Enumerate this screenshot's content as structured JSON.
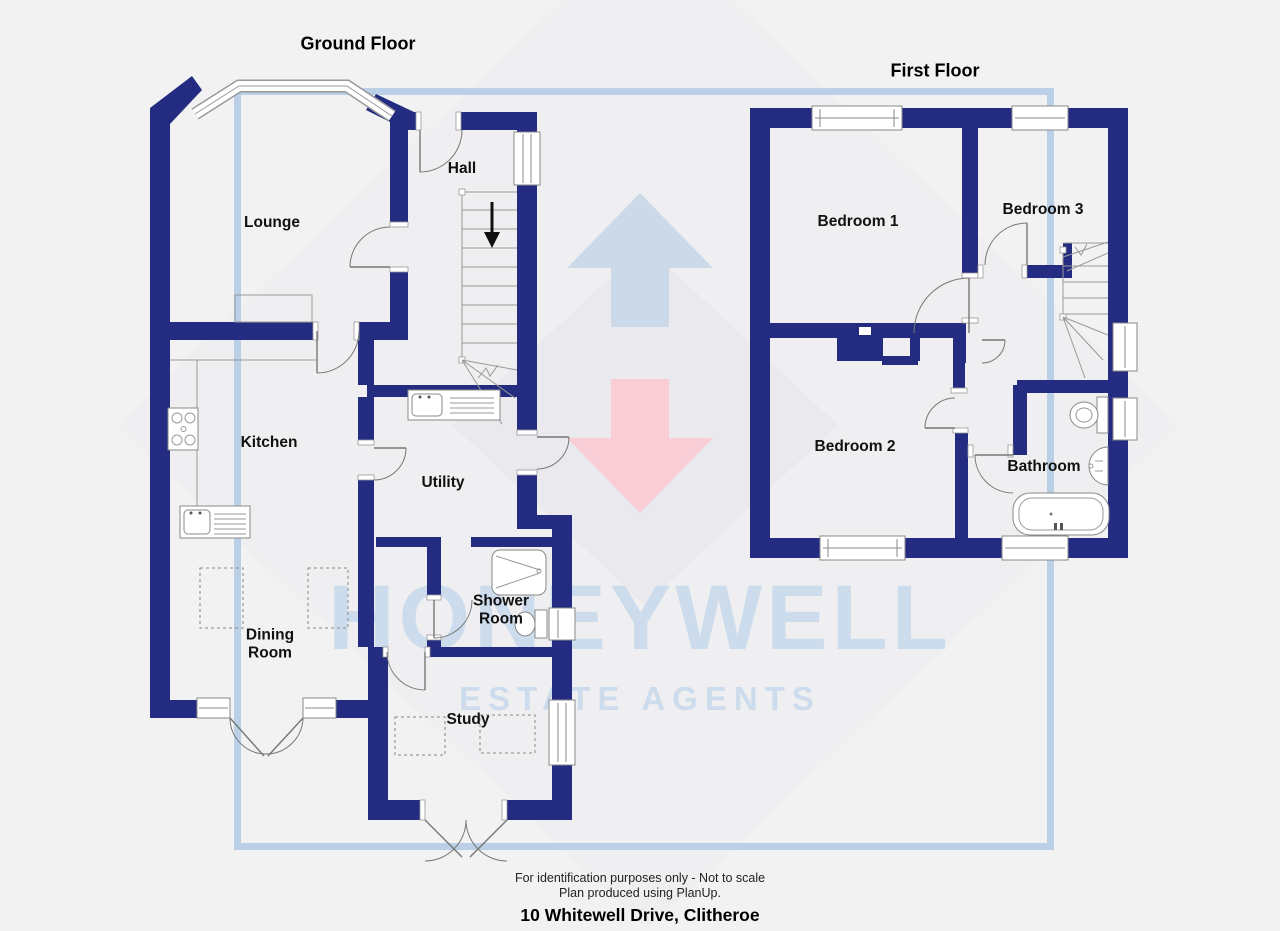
{
  "titles": {
    "ground_floor": "Ground Floor",
    "first_floor": "First Floor"
  },
  "rooms": {
    "lounge": "Lounge",
    "hall": "Hall",
    "kitchen": "Kitchen",
    "utility": "Utility",
    "dining_room": "Dining Room",
    "shower_room": "Shower Room",
    "study": "Study",
    "bedroom_1": "Bedroom 1",
    "bedroom_2": "Bedroom 2",
    "bedroom_3": "Bedroom 3",
    "bathroom": "Bathroom"
  },
  "watermark": {
    "brand_line1": "HONEYWELL",
    "brand_line2": "ESTATE AGENTS"
  },
  "footer": {
    "disclaimer_line1": "For identification purposes only - Not to scale",
    "disclaimer_line2": "Plan produced using PlanUp.",
    "address": "10 Whitewell Drive, Clitheroe"
  },
  "colors": {
    "wall": "#232c80",
    "watermark_text": "#cddcec",
    "watermark_frame": "#b1cae4",
    "arrow_up": "#ccd9e9",
    "arrow_down": "#f8cdd6",
    "diamond": "#e9e9ee"
  }
}
